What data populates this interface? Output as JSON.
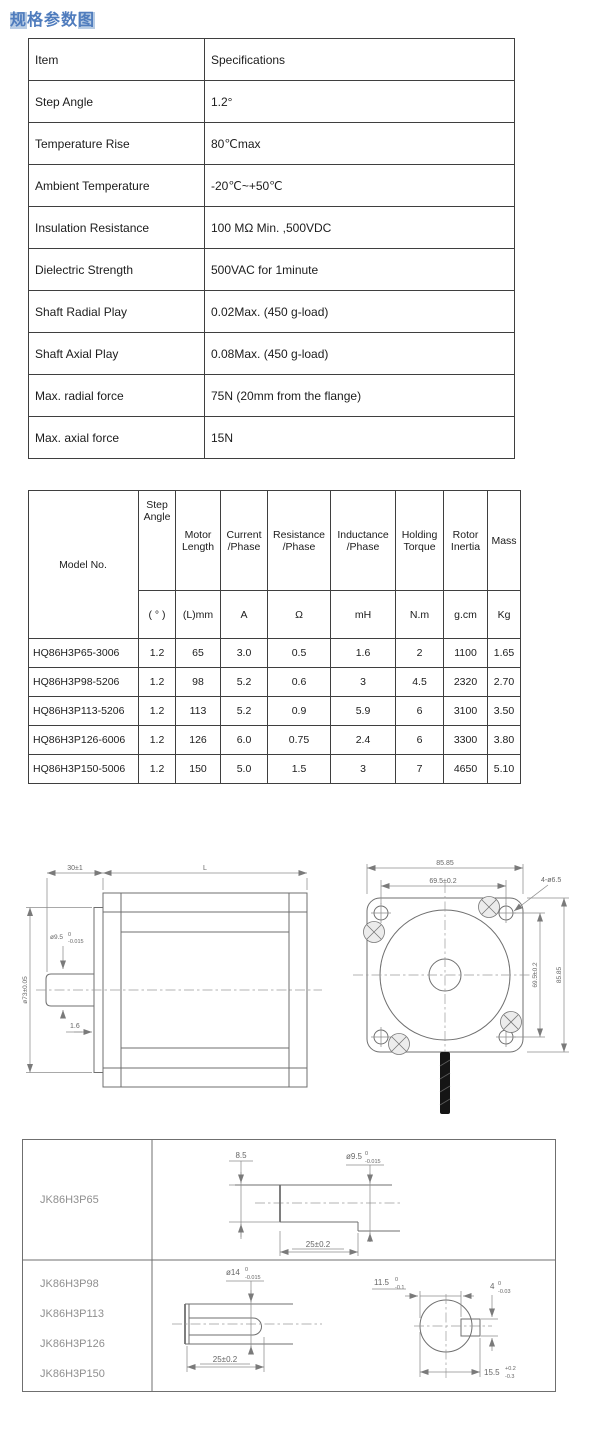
{
  "title": {
    "first": "规",
    "middle": "格参数",
    "last": "图"
  },
  "colors": {
    "title_blue": "#4f7cbd",
    "title_highlight": "#b8cce4"
  },
  "spec_table": {
    "headers": {
      "item": "Item",
      "spec": "Specifications"
    },
    "rows": [
      {
        "item": "Step Angle",
        "spec": "1.2°"
      },
      {
        "item": "Temperature Rise",
        "spec": "80℃max"
      },
      {
        "item": "Ambient Temperature",
        "spec": "-20℃~+50℃"
      },
      {
        "item": "Insulation Resistance",
        "spec": "100 MΩ Min. ,500VDC"
      },
      {
        "item": "Dielectric Strength",
        "spec": "500VAC for 1minute"
      },
      {
        "item": "Shaft Radial Play",
        "spec": "0.02Max. (450 g-load)"
      },
      {
        "item": "Shaft Axial Play",
        "spec": "0.08Max. (450 g-load)"
      },
      {
        "item": "Max. radial force",
        "spec": "75N (20mm from the flange)"
      },
      {
        "item": "Max. axial force",
        "spec": "15N"
      }
    ]
  },
  "model_table": {
    "headers": {
      "model": "Model No.",
      "step_angle": "Step Angle",
      "step_angle_unit": "( ° )",
      "motor_length": "Motor Length",
      "motor_length_unit": "(L)mm",
      "current": "Current /Phase",
      "current_unit": "A",
      "resistance": "Resistance /Phase",
      "resistance_unit": "Ω",
      "inductance": "Inductance /Phase",
      "inductance_unit": "mH",
      "torque": "Holding Torque",
      "torque_unit": "N.m",
      "inertia": "Rotor Inertia",
      "inertia_unit": "g.cm",
      "mass": "Mass",
      "mass_unit": "Kg"
    },
    "rows": [
      {
        "model": "HQ86H3P65-3006",
        "step": "1.2",
        "len": "65",
        "cur": "3.0",
        "res": "0.5",
        "ind": "1.6",
        "tor": "2",
        "rot": "1100",
        "mass": "1.65"
      },
      {
        "model": "HQ86H3P98-5206",
        "step": "1.2",
        "len": "98",
        "cur": "5.2",
        "res": "0.6",
        "ind": "3",
        "tor": "4.5",
        "rot": "2320",
        "mass": "2.70"
      },
      {
        "model": "HQ86H3P113-5206",
        "step": "1.2",
        "len": "113",
        "cur": "5.2",
        "res": "0.9",
        "ind": "5.9",
        "tor": "6",
        "rot": "3100",
        "mass": "3.50"
      },
      {
        "model": "HQ86H3P126-6006",
        "step": "1.2",
        "len": "126",
        "cur": "6.0",
        "res": "0.75",
        "ind": "2.4",
        "tor": "6",
        "rot": "3300",
        "mass": "3.80"
      },
      {
        "model": "HQ86H3P150-5006",
        "step": "1.2",
        "len": "150",
        "cur": "5.0",
        "res": "1.5",
        "ind": "3",
        "tor": "7",
        "rot": "4650",
        "mass": "5.10"
      }
    ]
  },
  "drawings": {
    "side_view": {
      "shaft_length": "30±1",
      "body_length": "L",
      "pilot_diameter": "ø73±0.05",
      "shaft_dia": "ø9.5",
      "shaft_dia_sup": "0",
      "shaft_dia_sub": "-0.015",
      "boss_height": "1.6"
    },
    "front_view": {
      "flange_width": "85.85",
      "bolt_spacing_top": "69.5±0.2",
      "mount_holes": "4-ø6.5",
      "bolt_spacing_side": "69.5±0.2",
      "flange_height": "85.85"
    }
  },
  "shaft_table": {
    "row1": {
      "model": "JK86H3P65",
      "flat_depth": "8.5",
      "dia": "ø9.5",
      "dia_sup": "0",
      "dia_sub": "-0.015",
      "flat_length": "25±0.2"
    },
    "row2": {
      "models": [
        "JK86H3P98",
        "JK86H3P113",
        "JK86H3P126",
        "JK86H3P150"
      ],
      "dia": "ø14",
      "dia_sup": "0",
      "dia_sub": "-0.015",
      "key_length": "25±0.2",
      "flat_width": "11.5",
      "flat_sup": "0",
      "flat_sub": "-0.1",
      "key_width": "4",
      "key_sup": "0",
      "key_sub": "-0.03",
      "total_height": "15.5",
      "height_sup": "+0.2",
      "height_sub": "-0.3"
    }
  }
}
